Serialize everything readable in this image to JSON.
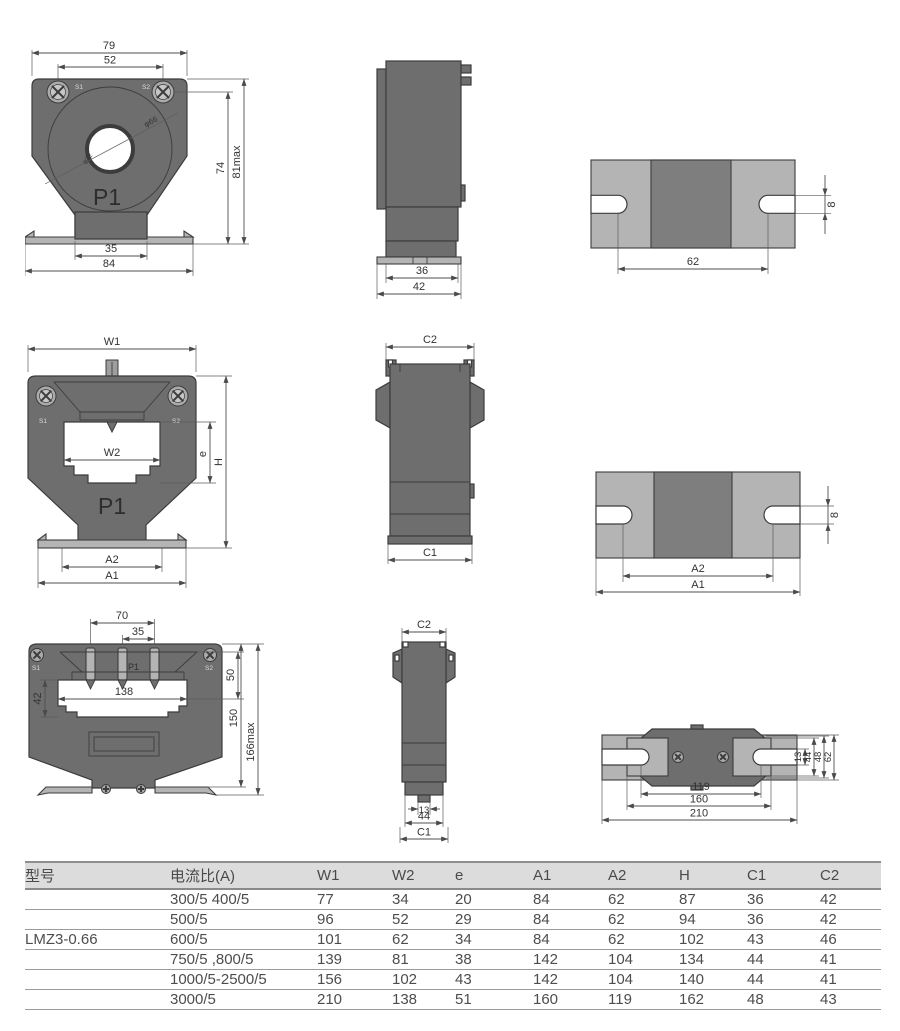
{
  "views": {
    "small_front": {
      "dims": {
        "w_top": "79",
        "screw_span": "52",
        "h_screw": "74",
        "h_max": "81max",
        "stem": "35",
        "base": "84",
        "outer_dia": "φ66",
        "inner_dia": "φ32"
      },
      "labels": {
        "s1": "S1",
        "s2": "S2",
        "p1": "P1"
      }
    },
    "small_side": {
      "dims": {
        "inner": "36",
        "outer": "42"
      }
    },
    "small_bottom": {
      "dims": {
        "span": "62",
        "slot": "8"
      }
    },
    "mid_front": {
      "dims": {
        "w1": "W1",
        "w2": "W2",
        "e": "e",
        "h": "H",
        "a2": "A2",
        "a1": "A1"
      },
      "labels": {
        "s1": "S1",
        "s2": "S2",
        "p1": "P1"
      }
    },
    "mid_side": {
      "dims": {
        "c2": "C2",
        "c1": "C1"
      }
    },
    "mid_bottom": {
      "dims": {
        "a2": "A2",
        "a1": "A1",
        "slot": "8"
      }
    },
    "large_front": {
      "dims": {
        "d70": "70",
        "d35": "35",
        "d50": "50",
        "d42": "42",
        "d138": "138",
        "d150": "150",
        "d166": "166max"
      },
      "labels": {
        "s1": "S1",
        "s2": "S2",
        "p1": "P1"
      }
    },
    "large_side": {
      "dims": {
        "c2": "C2",
        "d13": "13",
        "d44": "44",
        "c1": "C1"
      }
    },
    "large_bottom": {
      "dims": {
        "d13": "13",
        "d44": "44",
        "d48": "48",
        "d62": "62",
        "d119": "119",
        "d160": "160",
        "d210": "210"
      }
    }
  },
  "table": {
    "headers": [
      "型号",
      "电流比(A)",
      "W1",
      "W2",
      "e",
      "A1",
      "A2",
      "H",
      "C1",
      "C2"
    ],
    "model": "LMZ3-0.66",
    "rows": [
      {
        "ratio": "300/5 400/5",
        "w1": "77",
        "w2": "34",
        "e": "20",
        "a1": "84",
        "a2": "62",
        "h": "87",
        "c1": "36",
        "c2": "42"
      },
      {
        "ratio": "500/5",
        "w1": "96",
        "w2": "52",
        "e": "29",
        "a1": "84",
        "a2": "62",
        "h": "94",
        "c1": "36",
        "c2": "42"
      },
      {
        "ratio": "600/5",
        "w1": "101",
        "w2": "62",
        "e": "34",
        "a1": "84",
        "a2": "62",
        "h": "102",
        "c1": "43",
        "c2": "46"
      },
      {
        "ratio": "750/5 ,800/5",
        "w1": "139",
        "w2": "81",
        "e": "38",
        "a1": "142",
        "a2": "104",
        "h": "134",
        "c1": "44",
        "c2": "41"
      },
      {
        "ratio": "1000/5-2500/5",
        "w1": "156",
        "w2": "102",
        "e": "43",
        "a1": "142",
        "a2": "104",
        "h": "140",
        "c1": "44",
        "c2": "41"
      },
      {
        "ratio": "3000/5",
        "w1": "210",
        "w2": "138",
        "e": "51",
        "a1": "160",
        "a2": "119",
        "h": "162",
        "c1": "48",
        "c2": "43"
      }
    ]
  }
}
